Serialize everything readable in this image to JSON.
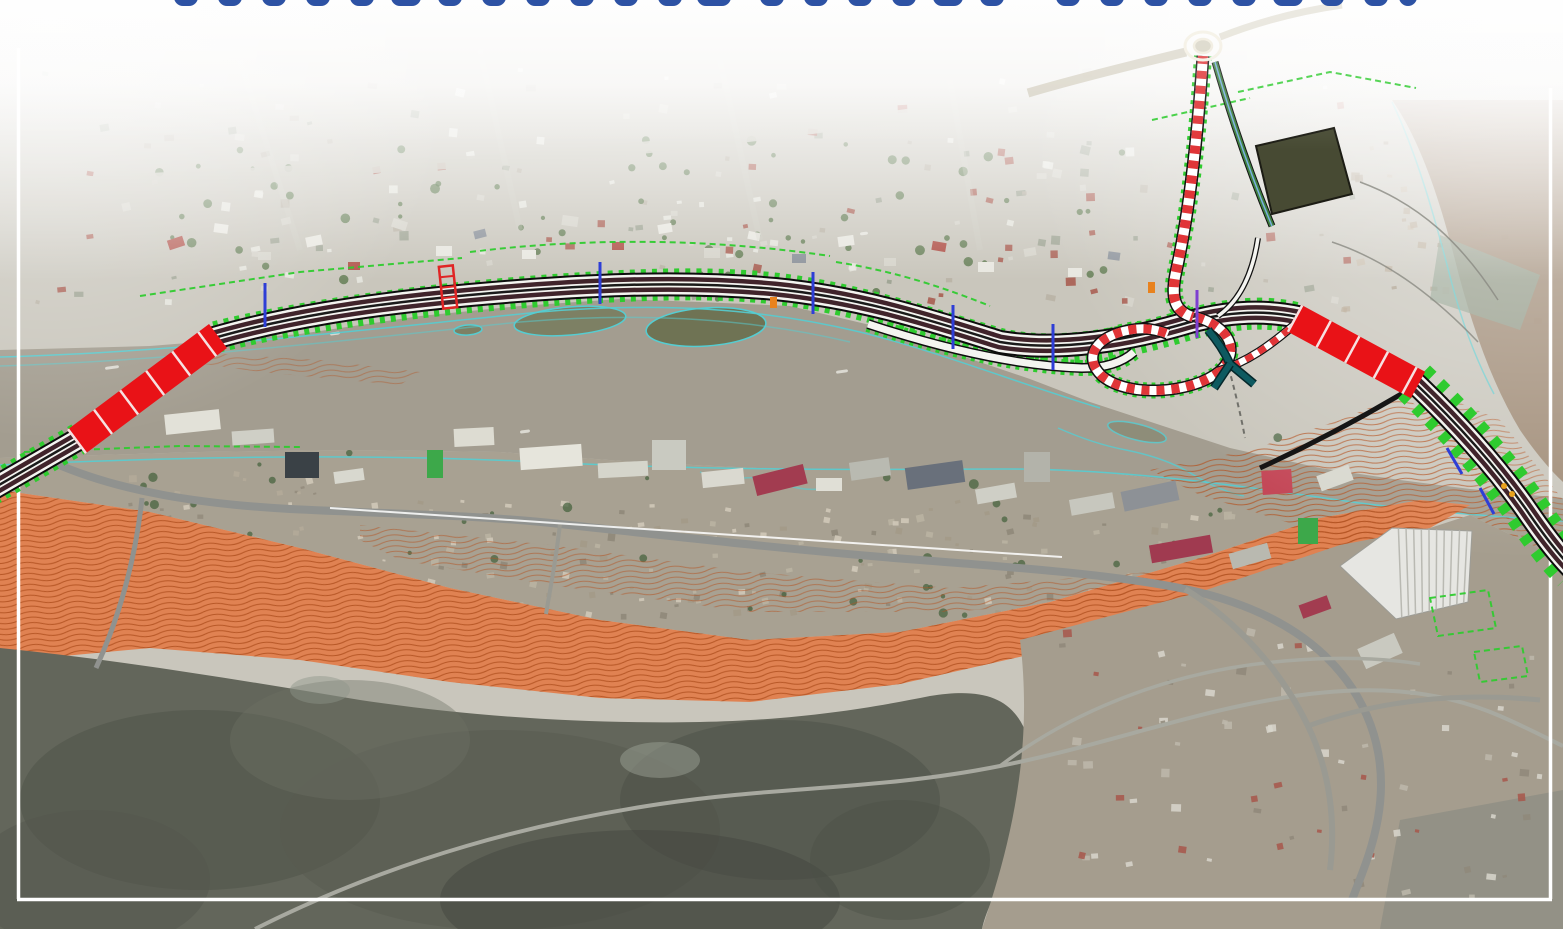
{
  "canvas": {
    "width": 1563,
    "height": 929
  },
  "palette": {
    "base_land": "#c9c6bc",
    "south_strip": "#a8a192",
    "river": "#a39d90",
    "river_ne_lobe": "#9f8a74",
    "river_teal_wedge": "#93a392",
    "orange_contour_base": "#e08252",
    "orange_contour_line": "#b35322",
    "mountains": "#63665b",
    "bottom_right_urban": "#a59d8e",
    "corner_hill": "#8e8e84",
    "road_gray": "#90928f",
    "road_light": "#c8c5ba",
    "cad_green": "#2fcb2f",
    "cad_cyan": "#55cdd2",
    "bridge_red": "#e91217",
    "carriageway_dark": "#40242b",
    "candy_red": "#e03538",
    "ramp_teal": "#0e5a60",
    "tick_blue": "#2e3ed6",
    "tick_purple": "#7e3fd0",
    "tick_orange": "#e8821e",
    "frame_white": "#ffffff",
    "title_blue": "#2d52a4"
  },
  "title_fragments": {
    "fill": "#2d52a4",
    "y": -16,
    "h": 22,
    "rx": 9,
    "positions": [
      {
        "x": 186,
        "w": 24
      },
      {
        "x": 230,
        "w": 24
      },
      {
        "x": 274,
        "w": 24
      },
      {
        "x": 318,
        "w": 24
      },
      {
        "x": 362,
        "w": 24
      },
      {
        "x": 406,
        "w": 30
      },
      {
        "x": 450,
        "w": 24
      },
      {
        "x": 494,
        "w": 24
      },
      {
        "x": 538,
        "w": 24
      },
      {
        "x": 582,
        "w": 24
      },
      {
        "x": 626,
        "w": 24
      },
      {
        "x": 670,
        "w": 24
      },
      {
        "x": 714,
        "w": 34
      },
      {
        "x": 772,
        "w": 24
      },
      {
        "x": 816,
        "w": 24
      },
      {
        "x": 860,
        "w": 24
      },
      {
        "x": 904,
        "w": 24
      },
      {
        "x": 948,
        "w": 30
      },
      {
        "x": 992,
        "w": 24
      },
      {
        "x": 1068,
        "w": 24
      },
      {
        "x": 1112,
        "w": 24
      },
      {
        "x": 1156,
        "w": 24
      },
      {
        "x": 1200,
        "w": 24
      },
      {
        "x": 1244,
        "w": 24
      },
      {
        "x": 1288,
        "w": 30
      },
      {
        "x": 1332,
        "w": 24
      },
      {
        "x": 1376,
        "w": 24
      },
      {
        "x": 1408,
        "w": 18
      }
    ]
  },
  "frame": {
    "color": "#ffffff",
    "width": 3.5,
    "left": {
      "d": "M 18.5 48 L 18.5 899"
    },
    "right": {
      "d": "M 1550.5 88 L 1550.5 899"
    },
    "bottom": {
      "d": "M 17 899.5 L 1552 899.5"
    }
  },
  "zones": {
    "base": {
      "x": 0,
      "y": 0,
      "w": 1563,
      "h": 929,
      "fill": "#c9c6bc"
    },
    "south_strip_poly": "0,458 200,452 350,450 500,452 650,463 800,470 950,468 1100,472 1250,490 1400,508 1563,522 1563,560 1470,515 1420,500 1320,518 1200,558 1050,602 900,632 750,640 600,620 450,588 300,548 150,512 0,490",
    "river_poly": "0,350 150,346 300,334 420,316 520,306 620,299 700,302 790,306 870,325 950,352 1030,379 1090,402 1160,425 1230,448 1320,468 1400,480 1470,489 1520,494 1563,498 1563,522 1400,508 1250,490 1100,472 950,468 800,470 650,463 500,452 350,450 200,452 0,458",
    "ne_lobe_d": "M 1392 100 C 1420 140 1440 200 1455 260 C 1470 320 1490 380 1520 430 C 1535 452 1550 470 1563 482 L 1563 100 Z",
    "teal_wedge": "1440,235 1540,275 1520,330 1430,300",
    "orange_band": "0,490 150,512 300,548 450,588 600,620 750,640 900,632 1050,602 1200,558 1320,518 1420,500 1470,505 1430,528 1330,552 1200,592 1050,650 900,684 750,702 600,698 450,682 300,660 150,648 0,662",
    "orange_overlay_houses": "360,525 550,545 750,572 950,588 1150,572 1250,555 1250,575 1100,600 950,612 750,612 550,585 400,560 360,540",
    "orange_overlay_interchange": "1150,470 1250,450 1340,420 1400,395 1440,420 1470,460 1500,500 1520,540 1470,560 1420,560 1360,545 1280,520 1200,495",
    "orange_overlay_ne": "1430,390 1500,420 1540,470 1563,500 1563,560 1540,560 1500,510 1450,450 1420,410",
    "orange_overlay_west_bank": "190,352 320,360 420,372 400,385 260,372 190,362",
    "mountains_d": "M 0 648 C 120 660 240 680 360 700 C 480 718 600 724 700 722 C 800 720 870 708 930 696 C 980 688 1010 696 1025 730 C 1038 770 1030 820 1005 870 C 992 900 985 915 982 929 L 0 929 Z",
    "br_urban_d": "M 1020 640 L 1200 592 L 1340 545 L 1430 528 L 1470 515 L 1563 560 L 1563 929 L 982 929 C 1005 860 1035 760 1020 640 Z",
    "corner_hill": "1400,820 1563,790 1563,929 1380,929",
    "field_quad": "1256,146 1334,128 1352,194 1272,214"
  },
  "water_marks": [
    {
      "x": 330,
      "y": 332,
      "w": 10,
      "h": 3
    },
    {
      "x": 836,
      "y": 370,
      "w": 12,
      "h": 3
    },
    {
      "x": 860,
      "y": 232,
      "w": 8,
      "h": 3
    },
    {
      "x": 105,
      "y": 366,
      "w": 14,
      "h": 3
    },
    {
      "x": 520,
      "y": 430,
      "w": 10,
      "h": 3
    }
  ],
  "islands": [
    {
      "cx": 570,
      "cy": 321,
      "rx": 56,
      "ry": 14,
      "rot": -5,
      "fill": "#7d8064"
    },
    {
      "cx": 706,
      "cy": 327,
      "rx": 60,
      "ry": 19,
      "rot": -4,
      "fill": "#6f7354"
    },
    {
      "cx": 468,
      "cy": 330,
      "rx": 14,
      "ry": 5,
      "rot": -4,
      "fill": "#7d8064"
    },
    {
      "cx": 1137,
      "cy": 432,
      "rx": 30,
      "ry": 8,
      "rot": 14,
      "fill": "#8a8a74",
      "op": 0.8
    }
  ],
  "cyan_lines": [
    {
      "d": "M 0 357 C 180 352 360 330 540 312 C 660 302 760 308 860 332 C 940 352 1020 384 1100 408",
      "op": 0.9
    },
    {
      "d": "M 0 366 C 180 360 350 340 520 322 C 640 312 750 318 850 342",
      "op": 0.5
    },
    {
      "d": "M 0 465 C 180 457 360 453 540 462 C 700 470 860 470 1000 469 C 1120 468 1240 486 1360 503 C 1430 512 1500 517 1563 521",
      "op": 0.9
    },
    {
      "d": "M 700 472 q 20 8 44 6 q 24 -2 40 6 q 20 8 44 4",
      "op": 0.6
    },
    {
      "d": "M 1058 428 q 36 16 68 22 q 40 8 66 24 q 30 18 52 22",
      "op": 0.8
    },
    {
      "d": "M 1392 102 C 1418 156 1436 222 1452 284 C 1462 322 1476 360 1494 394",
      "op": 0.7
    }
  ],
  "roads": {
    "south_main": {
      "d": "M 52 462 C 120 492 200 504 290 509 C 390 514 480 515 560 524 C 680 537 800 551 920 560 C 1020 568 1110 574 1185 589 C 1265 606 1320 640 1352 688 C 1378 728 1386 772 1378 818 C 1372 852 1360 878 1352 900",
      "w": 8,
      "color": "#90928f"
    },
    "south_branch": {
      "d": "M 142 498 C 136 556 120 616 96 668",
      "w": 5,
      "color": "#90928f"
    },
    "south_small": {
      "d": "M 560 524 C 556 560 550 590 546 614",
      "w": 4,
      "color": "#9a9a92"
    },
    "mountain_a": {
      "d": "M 255 929 C 400 856 540 822 660 804 C 780 786 880 790 1000 766 C 1100 746 1180 716 1270 700 C 1370 682 1440 690 1500 716 C 1530 729 1550 740 1563 746",
      "w": 4,
      "color": "#a8a9a0"
    },
    "mountain_b": {
      "d": "M 1000 766 C 1060 720 1140 684 1230 668 C 1300 656 1370 656 1420 664",
      "w": 3.5,
      "color": "#a8a9a0"
    },
    "br_urban_a": {
      "d": "M 1185 589 C 1235 620 1280 668 1308 726 C 1330 772 1336 820 1330 870",
      "w": 6,
      "color": "#9a9a92"
    },
    "br_urban_b": {
      "d": "M 1308 726 C 1380 700 1460 692 1540 700",
      "w": 5,
      "color": "#9a9a92"
    },
    "top_wide": {
      "d": "M 0 187 C 160 179 320 170 450 163 C 600 155 760 136 900 116 C 950 109 1000 100 1040 92",
      "w": 12,
      "color": "#c8c5ba",
      "op": 0.9
    },
    "faint_streets": [
      {
        "d": "M 240 60 L 300 250",
        "w": 6,
        "op": 0.3
      },
      {
        "d": "M 480 50 L 520 230",
        "w": 6,
        "op": 0.3
      },
      {
        "d": "M 720 60 L 760 240",
        "w": 6,
        "op": 0.3
      },
      {
        "d": "M 950 80 L 980 250",
        "w": 6,
        "op": 0.3
      }
    ]
  },
  "highway": {
    "mainline_d": "M -20 496 L 82 437 L 214 338 C 280 319 360 305 470 295 C 580 285 680 280 775 289 C 865 298 935 322 1000 342 C 1060 352 1130 340 1190 322 C 1230 311 1265 310 1298 317 L 1414 382 C 1462 428 1502 474 1530 515 C 1548 541 1560 556 1572 568",
    "green_under": [
      {
        "d": "M -20 496 L 80 438",
        "w": 32,
        "dash": "5 6"
      },
      {
        "d": "M 216 337 C 300 316 420 300 540 291 C 660 282 740 282 800 292 C 870 303 940 327 1000 344 C 1060 358 1130 342 1190 324 C 1235 312 1268 311 1296 318",
        "w": 32,
        "dash": "5 6"
      },
      {
        "d": "M 1414 382 C 1462 428 1502 474 1530 515 C 1548 541 1562 558 1574 570",
        "w": 46,
        "dash": "9 10"
      }
    ],
    "bridge_west_d": "M 76 442 L 218 336",
    "bridge_east_d": "M 1294 318 L 1418 385",
    "branch_d": "M 1203 56 C 1198 130 1190 210 1176 272 C 1170 300 1176 312 1193 317",
    "loop_d": "M 1196 317 C 1228 326 1242 350 1220 371 C 1192 394 1128 398 1102 376 C 1082 357 1096 336 1130 330 C 1144 327 1158 330 1168 334",
    "connector_d": "M 1218 371 C 1248 362 1272 344 1294 325",
    "collector_d": "M 868 324 C 950 351 1022 366 1082 368 C 1108 368 1124 361 1134 352",
    "teal_ramp": [
      "M 1208 330 C 1220 344 1226 355 1230 364 L 1254 384",
      "M 1230 364 L 1214 388"
    ],
    "side_road_ne_d": "M 1258 238 C 1252 278 1238 302 1218 316",
    "secondary_green_d": "M 1215 62 C 1234 128 1252 178 1272 226",
    "rb_west_road_d": "M 1186 52 C 1128 66 1072 80 1028 93",
    "rb_ne_road_d": "M 1220 37 C 1258 22 1300 11 1342 5",
    "black_walls": [
      "M 1408 390 C 1358 420 1308 446 1260 468",
      "M 1422 393 L 1482 464"
    ],
    "survey_line_d": "M 330 508 L 1062 557",
    "ped_bridge_d": "M 1224 350 C 1232 380 1240 410 1245 438"
  },
  "roundabout": {
    "cx": 1203,
    "cy": 46,
    "rx_outer": 18,
    "ry_outer": 14,
    "rx_inner": 9,
    "ry_inner": 7
  },
  "ticks_blue": [
    {
      "x1": 265,
      "y1": 283,
      "x2": 265,
      "y2": 327
    },
    {
      "x1": 600,
      "y1": 262,
      "x2": 600,
      "y2": 304
    },
    {
      "x1": 813,
      "y1": 272,
      "x2": 813,
      "y2": 314
    },
    {
      "x1": 953,
      "y1": 305,
      "x2": 953,
      "y2": 349
    },
    {
      "x1": 1053,
      "y1": 324,
      "x2": 1053,
      "y2": 370
    },
    {
      "x1": 1447,
      "y1": 448,
      "x2": 1462,
      "y2": 474
    },
    {
      "x1": 1480,
      "y1": 488,
      "x2": 1494,
      "y2": 514
    }
  ],
  "tick_purple": {
    "x1": 1197,
    "y1": 290,
    "x2": 1197,
    "y2": 338
  },
  "ticks_orange": [
    {
      "x": 770,
      "y": 297,
      "w": 7,
      "h": 11
    },
    {
      "x": 1148,
      "y": 282,
      "w": 7,
      "h": 11
    }
  ],
  "machinery_dots": [
    {
      "cx": 1504,
      "cy": 486
    },
    {
      "cx": 1512,
      "cy": 494
    }
  ],
  "overpass_red": {
    "x": 441,
    "y": 266,
    "w": 14,
    "h": 42,
    "rot": -6
  },
  "green_cad_lines": [
    "M 140 296 L 300 272 L 462 258",
    "M 470 252 C 600 236 720 240 830 256",
    "M 24 452 L 180 446 L 300 447",
    "M 1238 92 L 1330 72 L 1416 88",
    "M 1152 120 L 1250 98",
    "M 1430 598 l 58 -8 l 8 38 l -58 8 z",
    "M 1474 652 l 48 -6 l 6 30 l -48 6 z",
    "M 836 262 C 900 272 950 290 990 306"
  ],
  "gray_cad_lines": [
    "M 1360 182 C 1420 204 1462 244 1498 300",
    "M 1332 242 C 1392 262 1440 302 1478 342"
  ],
  "north_houses": [
    [
      168,
      238,
      16,
      10,
      -18,
      "#b0534a"
    ],
    [
      214,
      224,
      14,
      9,
      8,
      "#e8e7e0"
    ],
    [
      258,
      252,
      13,
      8,
      0,
      "#d6d4cb"
    ],
    [
      306,
      236,
      16,
      10,
      -12,
      "#e8e7e0"
    ],
    [
      348,
      262,
      12,
      8,
      0,
      "#b0534a"
    ],
    [
      392,
      220,
      15,
      9,
      18,
      "#d6d4cb"
    ],
    [
      436,
      246,
      16,
      10,
      0,
      "#e8e7e0"
    ],
    [
      474,
      230,
      12,
      8,
      -14,
      "#8d939b"
    ],
    [
      522,
      250,
      14,
      9,
      0,
      "#e8e7e0"
    ],
    [
      562,
      216,
      16,
      10,
      8,
      "#d6d4cb"
    ],
    [
      612,
      242,
      12,
      8,
      0,
      "#b0534a"
    ],
    [
      658,
      224,
      14,
      9,
      -10,
      "#e8e7e0"
    ],
    [
      704,
      248,
      16,
      10,
      0,
      "#d6d4cb"
    ],
    [
      748,
      232,
      12,
      8,
      12,
      "#e8e7e0"
    ],
    [
      792,
      254,
      14,
      9,
      0,
      "#8d939b"
    ],
    [
      838,
      236,
      16,
      10,
      -8,
      "#e8e7e0"
    ],
    [
      884,
      258,
      12,
      8,
      0,
      "#d6d4cb"
    ],
    [
      932,
      242,
      14,
      9,
      10,
      "#b0534a"
    ],
    [
      978,
      262,
      16,
      10,
      0,
      "#e8e7e0"
    ],
    [
      1024,
      248,
      12,
      8,
      -10,
      "#d6d4cb"
    ],
    [
      1068,
      268,
      14,
      9,
      0,
      "#e8e7e0"
    ],
    [
      1108,
      252,
      12,
      8,
      8,
      "#8d939b"
    ]
  ],
  "south_buildings": [
    [
      165,
      412,
      55,
      20,
      -6,
      "#e2e1d8"
    ],
    [
      232,
      430,
      42,
      14,
      -4,
      "#cfcfc6"
    ],
    [
      285,
      452,
      34,
      26,
      0,
      "#3a4146"
    ],
    [
      334,
      470,
      30,
      12,
      -8,
      "#d8d8cf"
    ],
    [
      427,
      450,
      16,
      28,
      0,
      "#3da84a"
    ],
    [
      454,
      428,
      40,
      18,
      -3,
      "#dddcd2"
    ],
    [
      520,
      446,
      62,
      22,
      -4,
      "#e6e5dc"
    ],
    [
      598,
      462,
      50,
      15,
      -3,
      "#d5d5cb"
    ],
    [
      652,
      440,
      34,
      30,
      0,
      "#c9cac1"
    ],
    [
      702,
      470,
      42,
      16,
      -6,
      "#dad9d0"
    ],
    [
      754,
      470,
      52,
      20,
      -14,
      "#a23c50"
    ],
    [
      816,
      478,
      26,
      13,
      0,
      "#e0dfd6"
    ],
    [
      850,
      460,
      40,
      18,
      -8,
      "#b9bab1"
    ],
    [
      906,
      464,
      58,
      22,
      -8,
      "#69707b"
    ],
    [
      976,
      486,
      40,
      15,
      -10,
      "#cfcfc6"
    ],
    [
      1024,
      452,
      26,
      30,
      0,
      "#b3b3aa"
    ],
    [
      1070,
      496,
      44,
      16,
      -10,
      "#c7c7be"
    ],
    [
      1122,
      486,
      56,
      20,
      -12,
      "#8d9196"
    ],
    [
      1150,
      540,
      62,
      18,
      -10,
      "#a03a50"
    ],
    [
      1230,
      548,
      40,
      16,
      -16,
      "#b9b9b0"
    ],
    [
      1262,
      470,
      30,
      24,
      -4,
      "#c44858"
    ],
    [
      1298,
      518,
      20,
      26,
      0,
      "#3da84a"
    ],
    [
      1318,
      470,
      34,
      16,
      -20,
      "#d8d8cf"
    ],
    [
      1360,
      640,
      40,
      22,
      -24,
      "#c9c9c0"
    ],
    [
      1300,
      600,
      30,
      14,
      -20,
      "#a23c50"
    ]
  ],
  "industrial": {
    "poly": "1340,566 1392,528 1472,531 1468,602 1396,619",
    "fill": "#e6e6e2",
    "stroke": "#9c9c96",
    "ribs": {
      "ax": 1392,
      "ay": 528,
      "bx": 1472,
      "by": 531,
      "cx": 1396,
      "cy": 619,
      "dx": 1468,
      "dy": 602,
      "n": 10,
      "stroke": "#b9b9b2",
      "w": 1.5
    }
  },
  "mountain_texture": [
    [
      200,
      800,
      180,
      90,
      "#4e5148",
      0.5
    ],
    [
      500,
      830,
      220,
      100,
      "#575a50",
      0.5
    ],
    [
      780,
      800,
      160,
      80,
      "#4a4d44",
      0.45
    ],
    [
      350,
      740,
      120,
      60,
      "#6e7065",
      0.4
    ],
    [
      640,
      900,
      200,
      70,
      "#434640",
      0.5
    ],
    [
      90,
      880,
      120,
      70,
      "#53564d",
      0.5
    ],
    [
      900,
      860,
      90,
      60,
      "#4c4f46",
      0.4
    ],
    [
      660,
      760,
      40,
      18,
      "#9aa093",
      0.5
    ],
    [
      320,
      690,
      30,
      14,
      "#8f958a",
      0.45
    ]
  ],
  "speckles": {
    "north": {
      "seed": 7,
      "count": 170,
      "x": 30,
      "y": 66,
      "w": 1320,
      "h": 240,
      "min": 4,
      "max": 10,
      "palette": [
        "#e8e7e0",
        "#d6d4cb",
        "#b9b2a4",
        "#a7574b",
        "#9aa08f"
      ],
      "op": 0.85
    },
    "south": {
      "seed": 21,
      "count": 150,
      "x": 340,
      "y": 500,
      "w": 900,
      "h": 115,
      "min": 3,
      "max": 8,
      "palette": [
        "#cfc8b8",
        "#b9b2a2",
        "#a39a88",
        "#8f887a"
      ],
      "op": 0.9
    },
    "south_w": {
      "seed": 33,
      "count": 40,
      "x": 60,
      "y": 470,
      "w": 280,
      "h": 90,
      "min": 3,
      "max": 8,
      "palette": [
        "#cfc8b8",
        "#b2aa99",
        "#948c7d"
      ],
      "op": 0.9
    },
    "br_urban": {
      "seed": 55,
      "count": 70,
      "x": 1040,
      "y": 620,
      "w": 500,
      "h": 280,
      "min": 4,
      "max": 10,
      "palette": [
        "#d8d6cd",
        "#bdb8ab",
        "#a7574b",
        "#8f887a"
      ],
      "op": 0.85
    },
    "ne_bar": {
      "seed": 77,
      "count": 30,
      "x": 1340,
      "y": 140,
      "w": 200,
      "h": 180,
      "min": 4,
      "max": 9,
      "palette": [
        "#b5a590",
        "#c4b6a2",
        "#a2937e"
      ],
      "op": 0.7
    }
  },
  "trees": {
    "north": {
      "seed": 101,
      "count": 70,
      "x": 130,
      "y": 140,
      "w": 1000,
      "h": 165,
      "min": 2,
      "max": 5,
      "color": "#4a6b3a",
      "op": 0.7
    },
    "south": {
      "seed": 131,
      "count": 60,
      "x": 80,
      "y": 430,
      "w": 1200,
      "h": 190,
      "min": 2,
      "max": 5,
      "color": "#42603a",
      "op": 0.7
    }
  }
}
